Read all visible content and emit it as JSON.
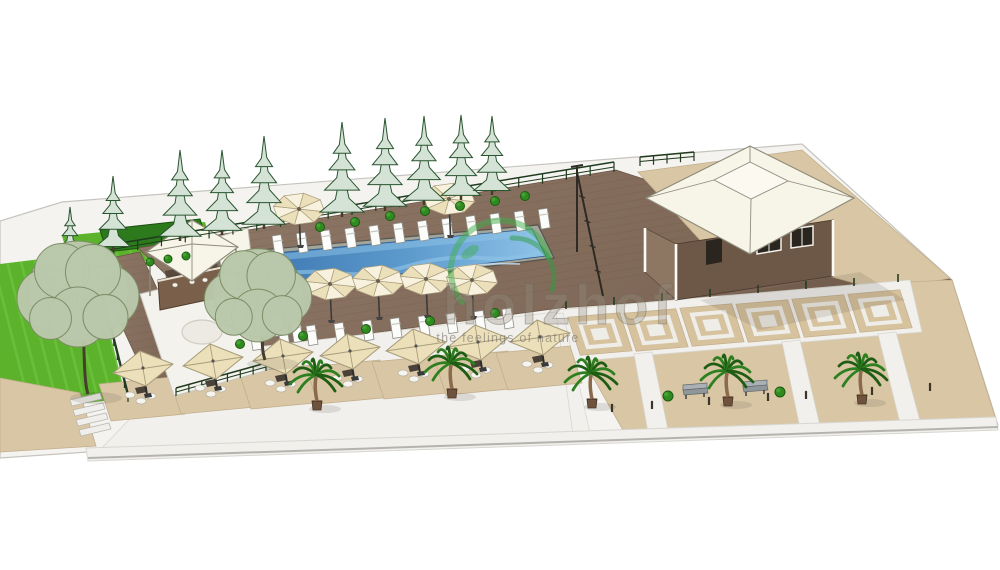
{
  "scene_description": "3D SketchUp-style architectural rendering of a resort pool terrace site plan",
  "watermark": {
    "brand": "holzhof",
    "tagline": "the feelings of nature",
    "logo_color": "#3fae4c",
    "logo_color2": "#2f9e40",
    "text_fill": "rgba(150,143,128,0.32)",
    "text_stroke": "rgba(105,98,88,0.42)",
    "tagline_fill": "rgba(110,104,94,0.55)"
  },
  "palette": {
    "background": "#ffffff",
    "ground": "#f4f3f0",
    "groundEdge": "#c6c4be",
    "deckA": "#907968",
    "deckB": "#7a6352",
    "plank": "#66523f",
    "tan": "#d9c6a4",
    "tanTile": "#d7c29e",
    "tanLine": "#c2ae8c",
    "white": "#f1f0ec",
    "whiteLine": "#d8d6d0",
    "poolCoping": "#a3a49a",
    "poolEdge": "#55564f",
    "poolDark": "#3a74ae",
    "poolMid": "#5d9bcd",
    "poolLight": "#8fc3e8",
    "poolGlint": "#c8e4f5",
    "grass": "#5cb32b",
    "grassLight": "#74c847",
    "hedge": "#2c7a1b",
    "hedgeDark": "#1b4f10",
    "pineFill": "#d4e3d6",
    "pineLine": "#2a5530",
    "trunk": "#4a3b28",
    "leafFill": "#bac8ab",
    "leafLine": "#7c8c64",
    "palmGreen": "#2d7f1f",
    "palmDark": "#1f5c14",
    "palmTrunk": "#8a6a4a",
    "pot": "#6f523c",
    "cream": "#ece0ba",
    "creamLight": "#f7f1dd",
    "ribs": "#a99d7d",
    "pole": "#333333",
    "roofWhite": "#f7f4e8",
    "roofTop": "#fbf9f0",
    "roofLine": "#8f8c7d",
    "wallFront": "#6d5847",
    "wallSide": "#8d7763",
    "windowDark": "#2b251f",
    "benchSeat": "#8f979b",
    "benchBack": "#aab1b4",
    "benchLine": "#62686b",
    "fence": "#203a1e",
    "shadow": "rgba(60,50,40,0.12)"
  },
  "regions": {
    "ground": [
      [
        0,
        221
      ],
      [
        62,
        202
      ],
      [
        700,
        152
      ],
      [
        802,
        144
      ],
      [
        952,
        280
      ],
      [
        998,
        425
      ],
      [
        640,
        436
      ],
      [
        88,
        452
      ],
      [
        0,
        458
      ]
    ],
    "grassUpper": [
      [
        62,
        236
      ],
      [
        205,
        222
      ],
      [
        214,
        254
      ],
      [
        72,
        268
      ]
    ],
    "grassMain": [
      [
        0,
        264
      ],
      [
        90,
        253
      ],
      [
        126,
        398
      ],
      [
        0,
        414
      ]
    ],
    "hedgeUpper": [
      [
        100,
        230
      ],
      [
        200,
        219
      ],
      [
        207,
        240
      ],
      [
        107,
        252
      ]
    ],
    "tanPathLeft": [
      [
        0,
        378
      ],
      [
        80,
        393
      ],
      [
        96,
        446
      ],
      [
        0,
        452
      ]
    ],
    "deck": [
      [
        138,
        248
      ],
      [
        616,
        170
      ],
      [
        952,
        280
      ],
      [
        560,
        308
      ],
      [
        245,
        350
      ]
    ],
    "deckArm": [
      [
        92,
        262
      ],
      [
        140,
        252
      ],
      [
        206,
        394
      ],
      [
        158,
        404
      ]
    ],
    "platformRight": [
      [
        638,
        172
      ],
      [
        802,
        150
      ],
      [
        950,
        278
      ],
      [
        886,
        292
      ],
      [
        700,
        240
      ]
    ],
    "plazaTan": [
      [
        556,
        312
      ],
      [
        908,
        282
      ],
      [
        952,
        280
      ],
      [
        996,
        420
      ],
      [
        624,
        432
      ]
    ],
    "whiteBand": [
      [
        556,
        310
      ],
      [
        910,
        280
      ],
      [
        922,
        332
      ],
      [
        568,
        362
      ]
    ],
    "terraceWhite": [
      [
        146,
        402
      ],
      [
        240,
        349
      ],
      [
        556,
        312
      ],
      [
        573,
        435
      ],
      [
        100,
        450
      ]
    ],
    "walkFront": [
      [
        86,
        448
      ],
      [
        996,
        417
      ],
      [
        998,
        430
      ],
      [
        88,
        461
      ]
    ],
    "crossWalks": [
      [
        [
          634,
          354
        ],
        [
          652,
          352
        ],
        [
          668,
          430
        ],
        [
          648,
          432
        ]
      ],
      [
        [
          782,
          342
        ],
        [
          800,
          340
        ],
        [
          820,
          426
        ],
        [
          800,
          428
        ]
      ],
      [
        [
          878,
          334
        ],
        [
          896,
          332
        ],
        [
          920,
          421
        ],
        [
          900,
          423
        ]
      ],
      [
        [
          548,
          315
        ],
        [
          563,
          313
        ],
        [
          590,
          433
        ],
        [
          573,
          435
        ]
      ]
    ],
    "platformLeft": [
      [
        140,
        294
      ],
      [
        232,
        271
      ],
      [
        268,
        370
      ],
      [
        174,
        396
      ]
    ],
    "poolCoping": [
      [
        238,
        252
      ],
      [
        538,
        225
      ],
      [
        554,
        258
      ],
      [
        258,
        296
      ]
    ],
    "poolWater": [
      [
        244,
        256
      ],
      [
        532,
        229
      ],
      [
        546,
        256
      ],
      [
        262,
        291
      ]
    ]
  },
  "buildings": {
    "pavilionMain": {
      "roofOuter": [
        [
          646,
          198
        ],
        [
          750,
          146
        ],
        [
          854,
          198
        ],
        [
          750,
          254
        ]
      ],
      "roofTop": [
        [
          714,
          180
        ],
        [
          750,
          162
        ],
        [
          788,
          181
        ],
        [
          751,
          199
        ]
      ],
      "wallFront": [
        [
          676,
          244
        ],
        [
          833,
          220
        ],
        [
          833,
          276
        ],
        [
          676,
          300
        ]
      ],
      "wallSide": [
        [
          645,
          228
        ],
        [
          676,
          244
        ],
        [
          676,
          300
        ],
        [
          645,
          272
        ]
      ],
      "door": [
        [
          706,
          241
        ],
        [
          722,
          238
        ],
        [
          722,
          262
        ],
        [
          706,
          265
        ]
      ],
      "windows": [
        [
          [
            757,
            234
          ],
          [
            781,
            230
          ],
          [
            781,
            250
          ],
          [
            757,
            254
          ]
        ],
        [
          [
            791,
            229
          ],
          [
            813,
            226
          ],
          [
            813,
            245
          ],
          [
            791,
            248
          ]
        ]
      ],
      "posts": [
        [
          [
            676,
            244
          ],
          [
            676,
            300
          ]
        ],
        [
          [
            833,
            220
          ],
          [
            833,
            276
          ]
        ],
        [
          [
            645,
            228
          ],
          [
            645,
            272
          ]
        ]
      ]
    },
    "barCabana": {
      "roof": [
        [
          146,
          252
        ],
        [
          192,
          220
        ],
        [
          238,
          247
        ],
        [
          192,
          281
        ]
      ],
      "apex": [
        192,
        244
      ],
      "counter": [
        [
          158,
          280
        ],
        [
          224,
          266
        ],
        [
          226,
          296
        ],
        [
          160,
          310
        ]
      ],
      "interior": [
        [
          165,
          271
        ],
        [
          220,
          259
        ],
        [
          222,
          274
        ],
        [
          167,
          286
        ]
      ]
    },
    "canopyWest": {
      "roof": [
        [
          46,
          272
        ],
        [
          84,
          244
        ],
        [
          120,
          266
        ],
        [
          84,
          298
        ]
      ],
      "apex": [
        84,
        268
      ]
    },
    "serviceTent": [
      [
        214,
        238
      ],
      [
        248,
        228
      ],
      [
        252,
        262
      ],
      [
        218,
        272
      ]
    ],
    "platformCircle": {
      "cx": 202,
      "cy": 332,
      "rx": 20,
      "ry": 12
    }
  },
  "pole": {
    "main": [
      [
        577,
        166
      ],
      [
        577,
        252
      ]
    ],
    "diag": [
      [
        577,
        172
      ],
      [
        603,
        296
      ]
    ],
    "top": [
      [
        571,
        167
      ],
      [
        583,
        165
      ]
    ]
  },
  "fences": {
    "top": {
      "from": [
        90,
        258
      ],
      "to": [
        614,
        172
      ],
      "posts": 22,
      "h": 10
    },
    "short": {
      "from": [
        640,
        166
      ],
      "to": [
        694,
        161
      ],
      "posts": 4,
      "h": 9
    },
    "left": {
      "from": [
        96,
        276
      ],
      "to": [
        128,
        402
      ],
      "posts": 9,
      "h": 9
    },
    "platformRail": {
      "from": [
        176,
        396
      ],
      "to": [
        266,
        371
      ],
      "posts": 7,
      "h": 8
    }
  },
  "pines": [
    {
      "x": 70,
      "y": 262,
      "h": 55
    },
    {
      "x": 113,
      "y": 248,
      "h": 72
    },
    {
      "x": 180,
      "y": 238,
      "h": 88
    },
    {
      "x": 222,
      "y": 232,
      "h": 82
    },
    {
      "x": 264,
      "y": 226,
      "h": 90
    },
    {
      "x": 342,
      "y": 214,
      "h": 92
    },
    {
      "x": 385,
      "y": 208,
      "h": 90
    },
    {
      "x": 424,
      "y": 202,
      "h": 86
    },
    {
      "x": 461,
      "y": 197,
      "h": 82
    },
    {
      "x": 492,
      "y": 192,
      "h": 76
    }
  ],
  "leafy_trees": [
    {
      "cx": 78,
      "cy": 296,
      "r": 50,
      "bx": 88,
      "by": 394
    },
    {
      "cx": 258,
      "cy": 297,
      "r": 44,
      "bx": 265,
      "by": 360
    }
  ],
  "palms": [
    [
      317,
      401
    ],
    [
      452,
      389
    ],
    [
      592,
      399
    ],
    [
      728,
      397
    ],
    [
      862,
      395
    ]
  ],
  "round_umbrellas": [
    [
      299,
      212
    ],
    [
      449,
      202
    ],
    [
      330,
      287
    ],
    [
      378,
      284
    ],
    [
      426,
      282
    ],
    [
      472,
      283
    ]
  ],
  "square_umbrellas": [
    [
      143,
      368
    ],
    [
      213,
      361
    ],
    [
      283,
      356
    ],
    [
      350,
      351
    ],
    [
      416,
      346
    ],
    [
      478,
      342
    ],
    [
      540,
      337
    ]
  ],
  "loungers": {
    "top": {
      "start": [
        272,
        236
      ],
      "step": [
        24.2,
        -2.4
      ],
      "count": 12
    },
    "mid": {
      "start": [
        250,
        331
      ],
      "step": [
        28,
        -2.4
      ],
      "count": 10
    },
    "left": [
      [
        236,
        305
      ],
      [
        254,
        311
      ],
      [
        272,
        317
      ],
      [
        291,
        323
      ]
    ]
  },
  "tiles": [
    [
      600,
      334
    ],
    [
      656,
      330
    ],
    [
      712,
      325
    ],
    [
      768,
      321
    ],
    [
      824,
      316
    ],
    [
      880,
      311
    ]
  ],
  "benches": [
    [
      695,
      391
    ],
    [
      755,
      388
    ]
  ],
  "bushes": {
    "plaza": [
      [
        668,
        396
      ],
      [
        780,
        392
      ]
    ],
    "deckEdge": [
      [
        240,
        344
      ],
      [
        303,
        336
      ],
      [
        366,
        329
      ],
      [
        430,
        321
      ],
      [
        495,
        313
      ]
    ],
    "topRow": [
      [
        320,
        227
      ],
      [
        355,
        222
      ],
      [
        390,
        216
      ],
      [
        425,
        211
      ],
      [
        460,
        206
      ],
      [
        495,
        201
      ],
      [
        525,
        196
      ]
    ],
    "left": [
      [
        150,
        262
      ],
      [
        168,
        259
      ],
      [
        186,
        256
      ]
    ]
  },
  "bollards": [
    [
      612,
      412
    ],
    [
      652,
      409
    ],
    [
      709,
      405
    ],
    [
      768,
      401
    ],
    [
      806,
      399
    ],
    [
      872,
      395
    ],
    [
      930,
      391
    ]
  ],
  "plazaPosts": [
    [
      566,
      301
    ],
    [
      614,
      297
    ],
    [
      662,
      293
    ],
    [
      710,
      289
    ],
    [
      758,
      285
    ],
    [
      806,
      281
    ],
    [
      854,
      278
    ],
    [
      898,
      274
    ]
  ],
  "steps": {
    "count": 4,
    "x": 70,
    "y": 400,
    "dx": 3,
    "dy": 10,
    "w": 30
  }
}
